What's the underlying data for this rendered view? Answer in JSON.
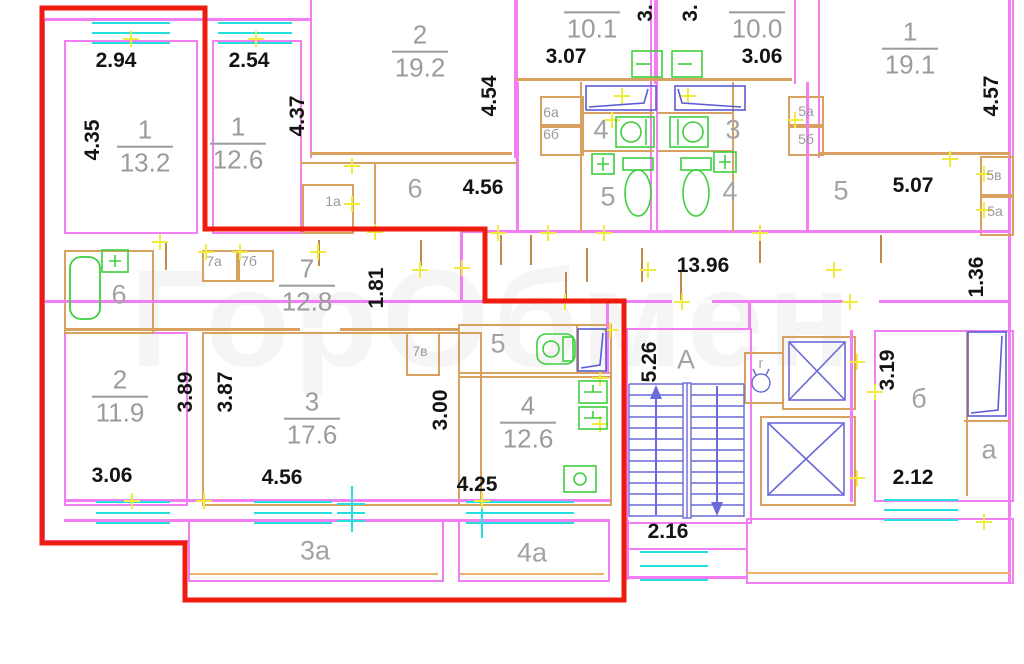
{
  "title": "floor-plan",
  "watermark": {
    "text": "ГорОбмен"
  },
  "colors": {
    "outer_wall": "#f37ef3",
    "partition": "#d8a160",
    "window": "#25dede",
    "fixture_green": "#3ecf3e",
    "fixture_blue": "#6a6ad8",
    "highlight_outline": "#ee1c0f",
    "dimension_text": "#141414",
    "room_text": "#9b9b9b"
  },
  "dimensions": [
    {
      "text": "2.94",
      "x": 116,
      "y": 61,
      "vertical": false
    },
    {
      "text": "2.54",
      "x": 249,
      "y": 61,
      "vertical": false
    },
    {
      "text": "3.07",
      "x": 566,
      "y": 57,
      "vertical": false
    },
    {
      "text": "3.06",
      "x": 762,
      "y": 57,
      "vertical": false
    },
    {
      "text": "4.56",
      "x": 483,
      "y": 188,
      "vertical": false
    },
    {
      "text": "5.07",
      "x": 913,
      "y": 186,
      "vertical": false
    },
    {
      "text": "13.96",
      "x": 703,
      "y": 266,
      "vertical": false
    },
    {
      "text": "3.06",
      "x": 112,
      "y": 476,
      "vertical": false
    },
    {
      "text": "4.56",
      "x": 282,
      "y": 478,
      "vertical": false
    },
    {
      "text": "4.25",
      "x": 477,
      "y": 485,
      "vertical": false
    },
    {
      "text": "2.16",
      "x": 668,
      "y": 532,
      "vertical": false
    },
    {
      "text": "2.12",
      "x": 913,
      "y": 478,
      "vertical": false
    },
    {
      "text": "4.35",
      "x": 93,
      "y": 140,
      "vertical": true
    },
    {
      "text": "4.37",
      "x": 298,
      "y": 116,
      "vertical": true
    },
    {
      "text": "4.54",
      "x": 490,
      "y": 96,
      "vertical": true
    },
    {
      "text": "3.",
      "x": 646,
      "y": 13,
      "vertical": true
    },
    {
      "text": "3.",
      "x": 691,
      "y": 13,
      "vertical": true
    },
    {
      "text": "4.57",
      "x": 992,
      "y": 96,
      "vertical": true
    },
    {
      "text": "1.81",
      "x": 377,
      "y": 288,
      "vertical": true
    },
    {
      "text": "1.36",
      "x": 977,
      "y": 277,
      "vertical": true
    },
    {
      "text": "3.89",
      "x": 186,
      "y": 392,
      "vertical": true
    },
    {
      "text": "3.87",
      "x": 226,
      "y": 392,
      "vertical": true
    },
    {
      "text": "3.00",
      "x": 441,
      "y": 410,
      "vertical": true
    },
    {
      "text": "5.26",
      "x": 650,
      "y": 362,
      "vertical": true
    },
    {
      "text": "3.19",
      "x": 888,
      "y": 370,
      "vertical": true
    }
  ],
  "room_labels": [
    {
      "number": "1",
      "area": "13.2",
      "x": 145,
      "y": 147
    },
    {
      "number": "1",
      "area": "12.6",
      "x": 238,
      "y": 144
    },
    {
      "number": "2",
      "area": "19.2",
      "x": 420,
      "y": 52
    },
    {
      "number": "",
      "area": "10.1",
      "x": 592,
      "y": 26
    },
    {
      "number": "",
      "area": "10.0",
      "x": 757,
      "y": 26
    },
    {
      "number": "1",
      "area": "19.1",
      "x": 910,
      "y": 49
    },
    {
      "number": "7",
      "area": "12.8",
      "x": 307,
      "y": 286
    },
    {
      "number": "2",
      "area": "11.9",
      "x": 120,
      "y": 397
    },
    {
      "number": "3",
      "area": "17.6",
      "x": 312,
      "y": 419
    },
    {
      "number": "4",
      "area": "12.6",
      "x": 528,
      "y": 423
    }
  ],
  "marks": [
    {
      "text": "6",
      "x": 415,
      "y": 189,
      "small": false
    },
    {
      "text": "1а",
      "x": 333,
      "y": 201,
      "small": true
    },
    {
      "text": "6а",
      "x": 551,
      "y": 112,
      "small": true
    },
    {
      "text": "6б",
      "x": 551,
      "y": 134,
      "small": true
    },
    {
      "text": "4",
      "x": 601,
      "y": 130,
      "small": false
    },
    {
      "text": "5",
      "x": 608,
      "y": 197,
      "small": false
    },
    {
      "text": "3",
      "x": 733,
      "y": 130,
      "small": false
    },
    {
      "text": "4",
      "x": 730,
      "y": 192,
      "small": false
    },
    {
      "text": "5а",
      "x": 806,
      "y": 111,
      "small": true
    },
    {
      "text": "5б",
      "x": 806,
      "y": 139,
      "small": true
    },
    {
      "text": "5",
      "x": 841,
      "y": 191,
      "small": false
    },
    {
      "text": "5в",
      "x": 994,
      "y": 175,
      "small": true
    },
    {
      "text": "5а",
      "x": 995,
      "y": 211,
      "small": true
    },
    {
      "text": "6",
      "x": 119,
      "y": 295,
      "small": false
    },
    {
      "text": "7а",
      "x": 214,
      "y": 261,
      "small": true
    },
    {
      "text": "7б",
      "x": 249,
      "y": 261,
      "small": true
    },
    {
      "text": "7в",
      "x": 420,
      "y": 351,
      "small": true
    },
    {
      "text": "5",
      "x": 498,
      "y": 344,
      "small": false
    },
    {
      "text": "А",
      "x": 686,
      "y": 360,
      "small": false
    },
    {
      "text": "г",
      "x": 761,
      "y": 363,
      "small": true
    },
    {
      "text": "3а",
      "x": 315,
      "y": 551,
      "small": false
    },
    {
      "text": "4а",
      "x": 532,
      "y": 553,
      "small": false
    },
    {
      "text": "б",
      "x": 919,
      "y": 399,
      "small": false
    },
    {
      "text": "а",
      "x": 989,
      "y": 450,
      "small": false
    }
  ]
}
